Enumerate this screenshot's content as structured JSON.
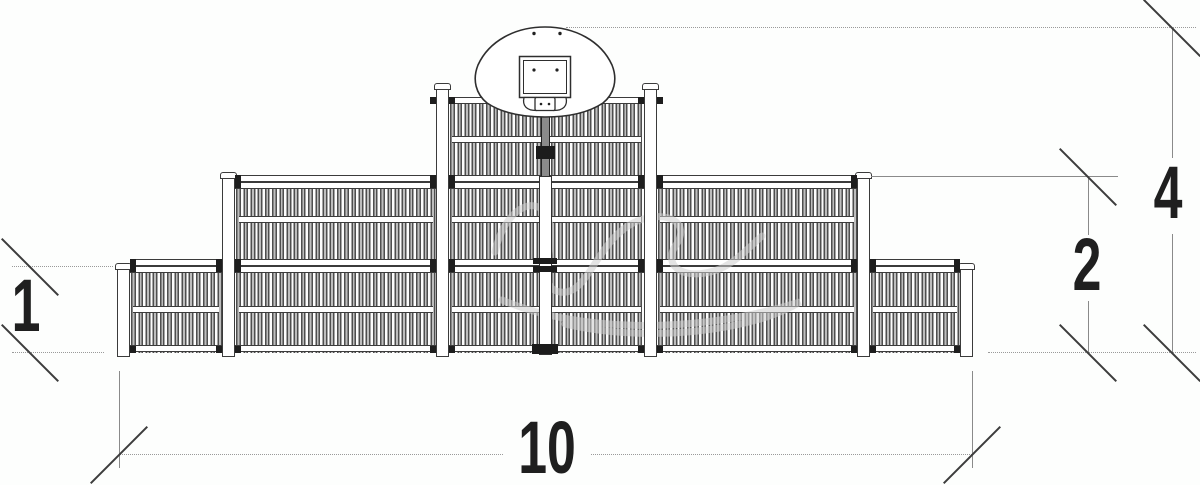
{
  "drawing": {
    "type": "technical-elevation",
    "subject": "multi-sport fence with basketball backboard",
    "colors": {
      "background": "#fdfefd",
      "line": "#3b3b3b",
      "bar_fill": "#bdbdbd",
      "clamp": "#1e1e1e",
      "dimension_line": "#9a9a9a",
      "dimension_text": "#1f1f1f",
      "watermark": "#cfcfcf"
    }
  },
  "dimensions": {
    "height_low": "1",
    "height_mid": "2",
    "height_total": "4",
    "width_total": "10"
  },
  "icons": {
    "backboard": "basketball-backboard-icon",
    "watermark": "manufacturer-watermark"
  }
}
